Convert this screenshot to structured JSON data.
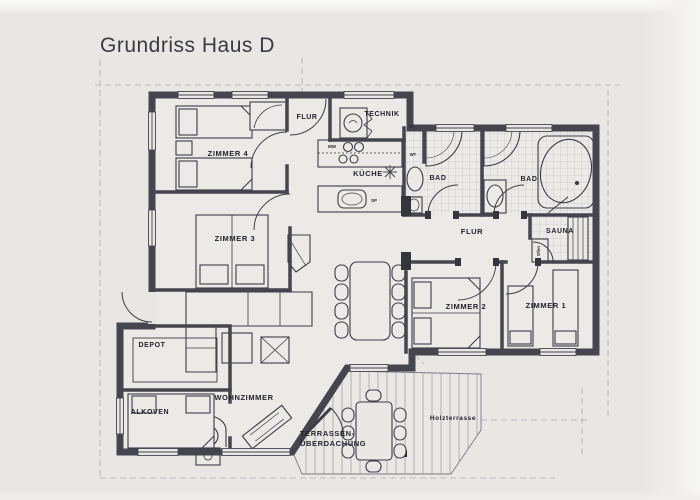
{
  "title": "Grundriss Haus D",
  "colors": {
    "paper": "#e8e7e4",
    "interior": "#ebeae7",
    "wall": "#45454f",
    "ink": "#3c3c46",
    "guide": "#acacb2",
    "tile": "#bcbcc2"
  },
  "labels": {
    "zimmer4": "ZIMMER 4",
    "zimmer3": "ZIMMER 3",
    "zimmer2": "ZIMMER 2",
    "zimmer1": "ZIMMER 1",
    "flur_top": "FLUR",
    "flur_mid": "FLUR",
    "technik": "TECHNIK",
    "kueche": "KÜCHE",
    "bad_left": "BAD",
    "bad_right": "BAD",
    "sauna": "SAUNA",
    "ofen": "Ofen",
    "depot": "DEPOT",
    "alkoven": "ALKOVEN",
    "wohnzimmer": "WOHNZIMMER",
    "terrasse_line1": "TERRASSEN-",
    "terrasse_line2": "ÜBERDACHUNG",
    "holzterrasse": "Holzterrasse",
    "mw": "MW",
    "sp": "SP",
    "wt_upper": "WT",
    "wt_lower": "WT"
  }
}
